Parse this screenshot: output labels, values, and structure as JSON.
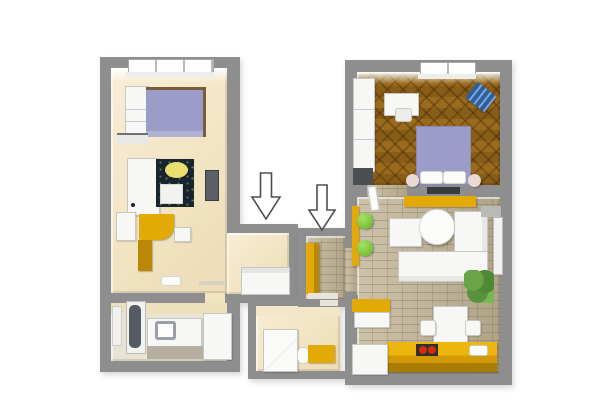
{
  "scene": {
    "type": "3d-floorplan-render",
    "background": "#ffffff",
    "units_count": 2,
    "annotation": "two-downward-arrows"
  },
  "palette": {
    "wall": "#8e8e8e",
    "wall_dark": "#6f6f6f",
    "floor_cream": "#f2e3c1",
    "floor_cream_light": "#f8edd6",
    "parquet_light": "#9a6b1d",
    "parquet_dark": "#7a5212",
    "stone_light": "#cdc3aa",
    "stone_dark": "#b0a488",
    "accent_yellow": "#e2a907",
    "accent_yellow_dark": "#bb8806",
    "bed_lavender": "#9c9cc8",
    "rug_dark": "#1a242e",
    "lamp_yellow": "#eade6e",
    "pouf_green": "#77c335",
    "stove_red": "#d22b0e",
    "chair_blue": "#2e5f9e",
    "plant_green": "#59923f",
    "tv_dark": "#3a3b3f",
    "furniture_white": "#f7f7f6",
    "furniture_border": "#c6c6c4"
  },
  "apartments": [
    {
      "id": "left-unit",
      "style": "studio",
      "rooms": [
        {
          "name": "living-bedroom",
          "floor": "cream",
          "furniture": [
            "window",
            "wardrobe",
            "double-bed",
            "wall-shelf",
            "fridge",
            "dark-rug",
            "round-yellow-lamp-table",
            "white-side-table",
            "wall-tv",
            "yellow-desk",
            "yellow-cabinet",
            "armchair",
            "door-mat",
            "niche-sofa"
          ]
        },
        {
          "name": "bathroom",
          "floor": "cream",
          "furniture": [
            "bathtub",
            "radiator",
            "washbasin-counter",
            "sink",
            "step",
            "tall-cabinet"
          ]
        }
      ]
    },
    {
      "id": "right-unit",
      "style": "two-room",
      "rooms": [
        {
          "name": "bedroom",
          "floor": "parquet-herringbone",
          "furniture": [
            "wardrobe",
            "dark-dresser",
            "desk",
            "desk-chair",
            "window",
            "blue-lounger",
            "double-bed",
            "pillows",
            "bedside-poufs"
          ]
        },
        {
          "name": "living-room",
          "floor": "stone-tile",
          "furniture": [
            "wall-tv",
            "yellow-sideboard",
            "yellow-wall-shelf",
            "green-pouf",
            "green-pouf",
            "square-ottoman",
            "round-table",
            "corner-sofa",
            "side-window",
            "plant",
            "open-door"
          ]
        },
        {
          "name": "kitchen",
          "floor": "stone-tile",
          "furniture": [
            "yellow-counter",
            "cooktop-red-burners",
            "sink",
            "fridge",
            "yellow-cabinet",
            "dining-table",
            "chair",
            "chair"
          ]
        },
        {
          "name": "hallway",
          "floor": "stone-tile",
          "furniture": [
            "yellow-wardrobe",
            "threshold"
          ]
        },
        {
          "name": "bathroom",
          "floor": "cream",
          "furniture": [
            "shower-cabin",
            "toilet",
            "yellow-bench"
          ]
        }
      ]
    }
  ],
  "arrows": [
    {
      "name": "arrow-to-left-unit",
      "direction": "down"
    },
    {
      "name": "arrow-to-right-unit",
      "direction": "down"
    }
  ]
}
